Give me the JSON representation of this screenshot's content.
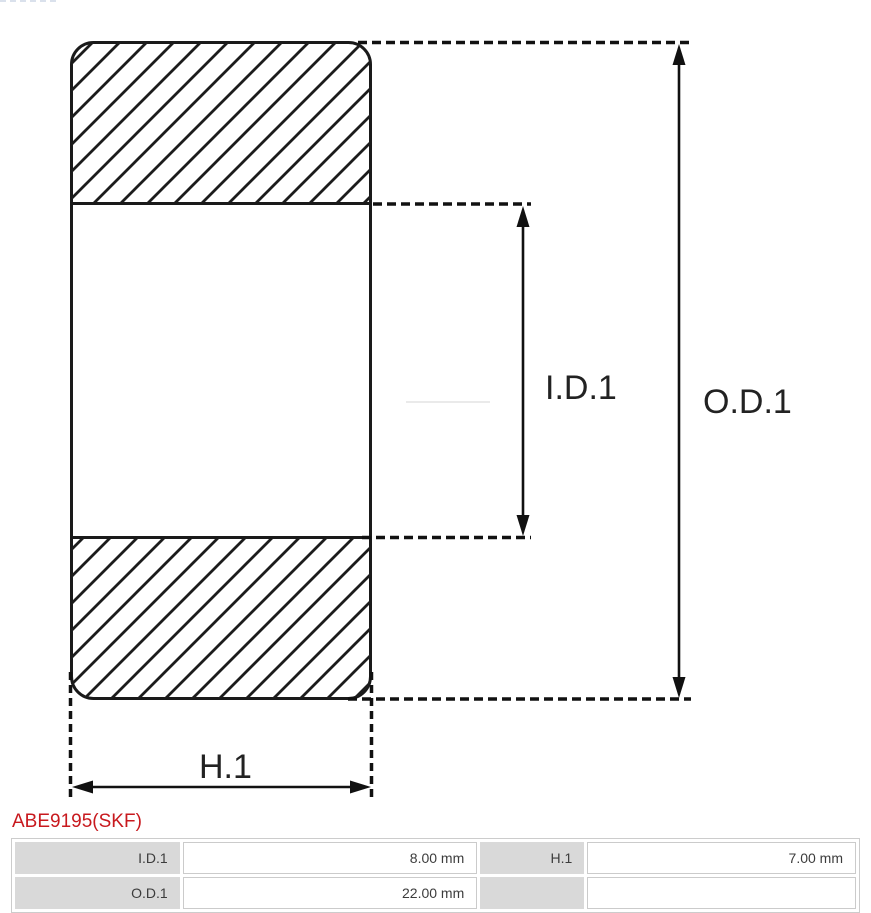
{
  "part": {
    "number": "ABE9195(SKF)"
  },
  "diagram": {
    "type": "bearing-cross-section",
    "labels": {
      "inner_diameter": "I.D.1",
      "outer_diameter": "O.D.1",
      "height": "H.1"
    }
  },
  "spec_table": {
    "rows": [
      {
        "cells": [
          {
            "label": "I.D.1",
            "value": "8.00 mm"
          },
          {
            "label": "H.1",
            "value": "7.00 mm"
          }
        ]
      },
      {
        "cells": [
          {
            "label": "O.D.1",
            "value": "22.00 mm"
          },
          {
            "label": "",
            "value": ""
          }
        ]
      }
    ]
  },
  "colors": {
    "accent_red": "#c8191e",
    "table_header_bg": "#d9d9d9",
    "table_border": "#cccccc",
    "drawing_line": "#1a1a1a"
  }
}
